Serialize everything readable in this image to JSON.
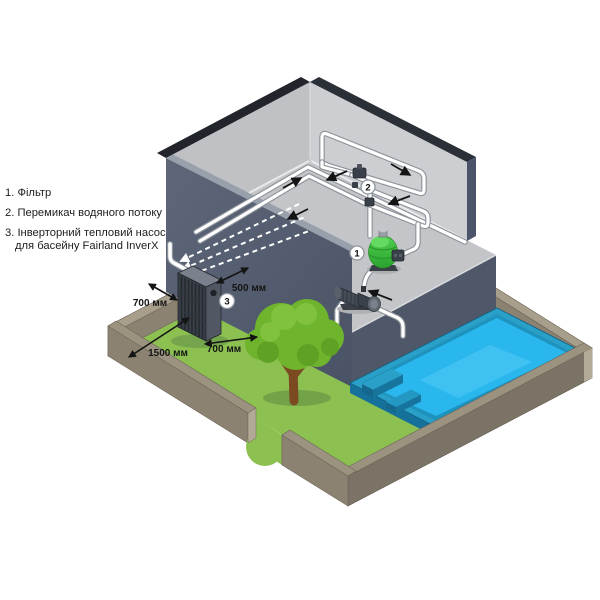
{
  "scene": {
    "legend": {
      "items": [
        {
          "text": "1. Фільтр"
        },
        {
          "text": "2. Перемикач водяного потоку"
        },
        {
          "text": "3. Інверторний тепловий насос",
          "text2": "для басейну Fairland InverX"
        }
      ]
    },
    "badges": {
      "filter": "1",
      "flow_switch": "2",
      "heat_pump": "3"
    },
    "dimensions": {
      "to_wall": "500 мм",
      "side_left": "700 мм",
      "front": "1500 мм",
      "side_right": "700 мм"
    },
    "colors": {
      "wall_dark": "#545d6e",
      "wall_top": "#23262c",
      "interior_wall": "#cbcdd0",
      "floor": "#c4c5c8",
      "grass": "#8cc152",
      "fence_top": "#9c9280",
      "fence_face": "#8c8272",
      "pool_rim": "#2aa0c8",
      "water": "#29b7ee",
      "tree_green": "#6fb42d",
      "filter_green": "#3ec43e",
      "pipe": "#ffffff",
      "annotation": "#141414"
    }
  }
}
